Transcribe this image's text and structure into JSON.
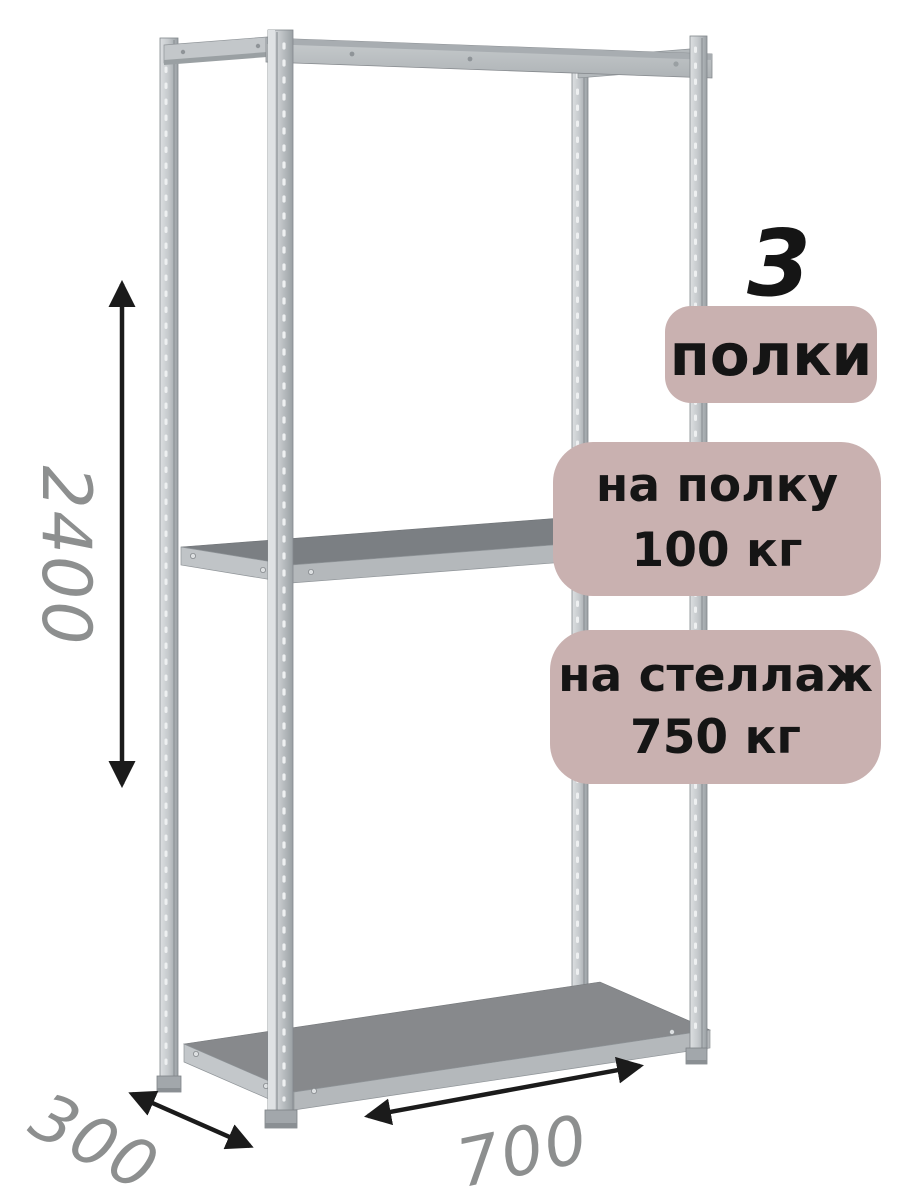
{
  "dimensions": {
    "height_mm": "2400",
    "depth_mm": "300",
    "width_mm": "700"
  },
  "badges": {
    "count_number": "3",
    "count_label": "полки",
    "shelf_load_line1": "на полку",
    "shelf_load_line2": "100 кг",
    "rack_load_line1": "на стеллаж",
    "rack_load_line2": "750 кг"
  },
  "rack": {
    "shelves_shown": 3,
    "posts_shown": 4
  },
  "colors": {
    "background": "#ffffff",
    "badge_background": "#c9b1b0",
    "badge_text": "#151515",
    "dimension_text": "#8d8f8f",
    "arrow": "#1b1b1b",
    "metal_light": "#dcdfe1",
    "metal_mid": "#b6babd",
    "metal_dark": "#83878b",
    "shelf_top_middle": "#7b7f83",
    "shelf_top_bottom": "#87898c"
  }
}
